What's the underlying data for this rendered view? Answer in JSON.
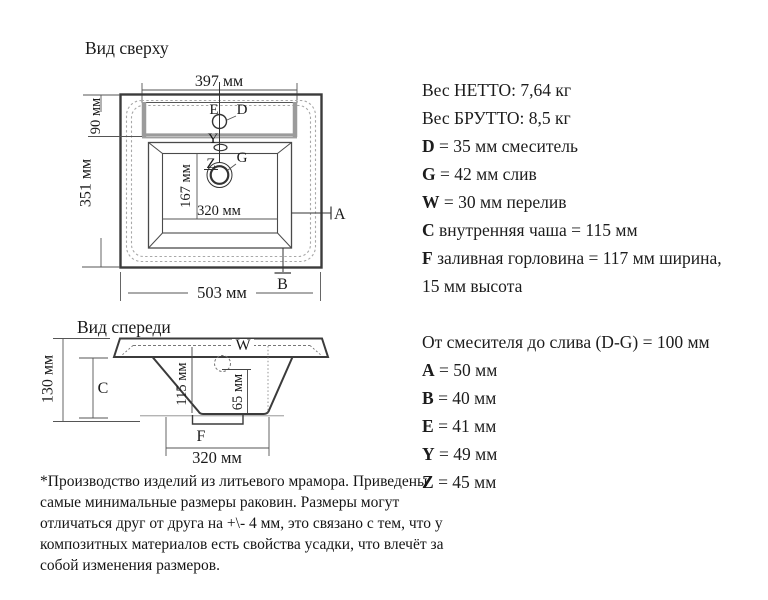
{
  "colors": {
    "ink": "#1a1a1a",
    "line": "#3b3b3b",
    "muted": "#999999",
    "background": "#ffffff"
  },
  "top_view": {
    "title": "Вид сверху",
    "dim_width_top": "397 мм",
    "dim_deck": "90 мм",
    "dim_height": "351 мм",
    "dim_inner_height": "167 мм",
    "dim_inner_width": "320 мм",
    "dim_width_bottom": "503 мм",
    "labels": {
      "e": "E",
      "d": "D",
      "y": "Y",
      "z": "Z",
      "g": "G",
      "a": "A",
      "b": "B"
    }
  },
  "front_view": {
    "title": "Вид спереди",
    "dim_height": "130 мм",
    "label_c": "C",
    "label_w": "W",
    "dim_depth": "115 мм",
    "dim_overflow_depth": "65 мм",
    "label_f": "F",
    "dim_width": "320 мм"
  },
  "right_panel": {
    "lines": [
      {
        "b": "",
        "t": "Вес НЕТТО: 7,64 кг"
      },
      {
        "b": "",
        "t": "Вес БРУТТО: 8,5 кг"
      },
      {
        "b": "D",
        "t": " = 35 мм смеситель"
      },
      {
        "b": "G",
        "t": " = 42 мм слив"
      },
      {
        "b": "W",
        "t": " = 30 мм перелив"
      },
      {
        "b": "C",
        "t": " внутренняя чаша = 115 мм"
      },
      {
        "b": "F",
        "t": " заливная горловина = 117 мм ширина,"
      },
      {
        "b": "",
        "t": "15 мм высота"
      },
      {
        "b": "",
        "t": ""
      },
      {
        "b": "",
        "t": "От смесителя до слива (D-G) = 100 мм"
      },
      {
        "b": "A",
        "t": " = 50 мм"
      },
      {
        "b": "B",
        "t": " = 40 мм"
      },
      {
        "b": "E",
        "t": " = 41 мм"
      },
      {
        "b": "Y",
        "t": " = 49 мм"
      },
      {
        "b": "Z",
        "t": " = 45 мм"
      }
    ]
  },
  "footnote": {
    "lines": [
      "*Производство изделий из литьевого мрамора. Приведены",
      "самые минимальные размеры раковин. Размеры могут",
      "отличаться друг от друга на +\\- 4 мм, это связано с тем, что у",
      "композитных материалов есть свойства усадки, что влечёт за",
      "собой изменения размеров."
    ]
  }
}
